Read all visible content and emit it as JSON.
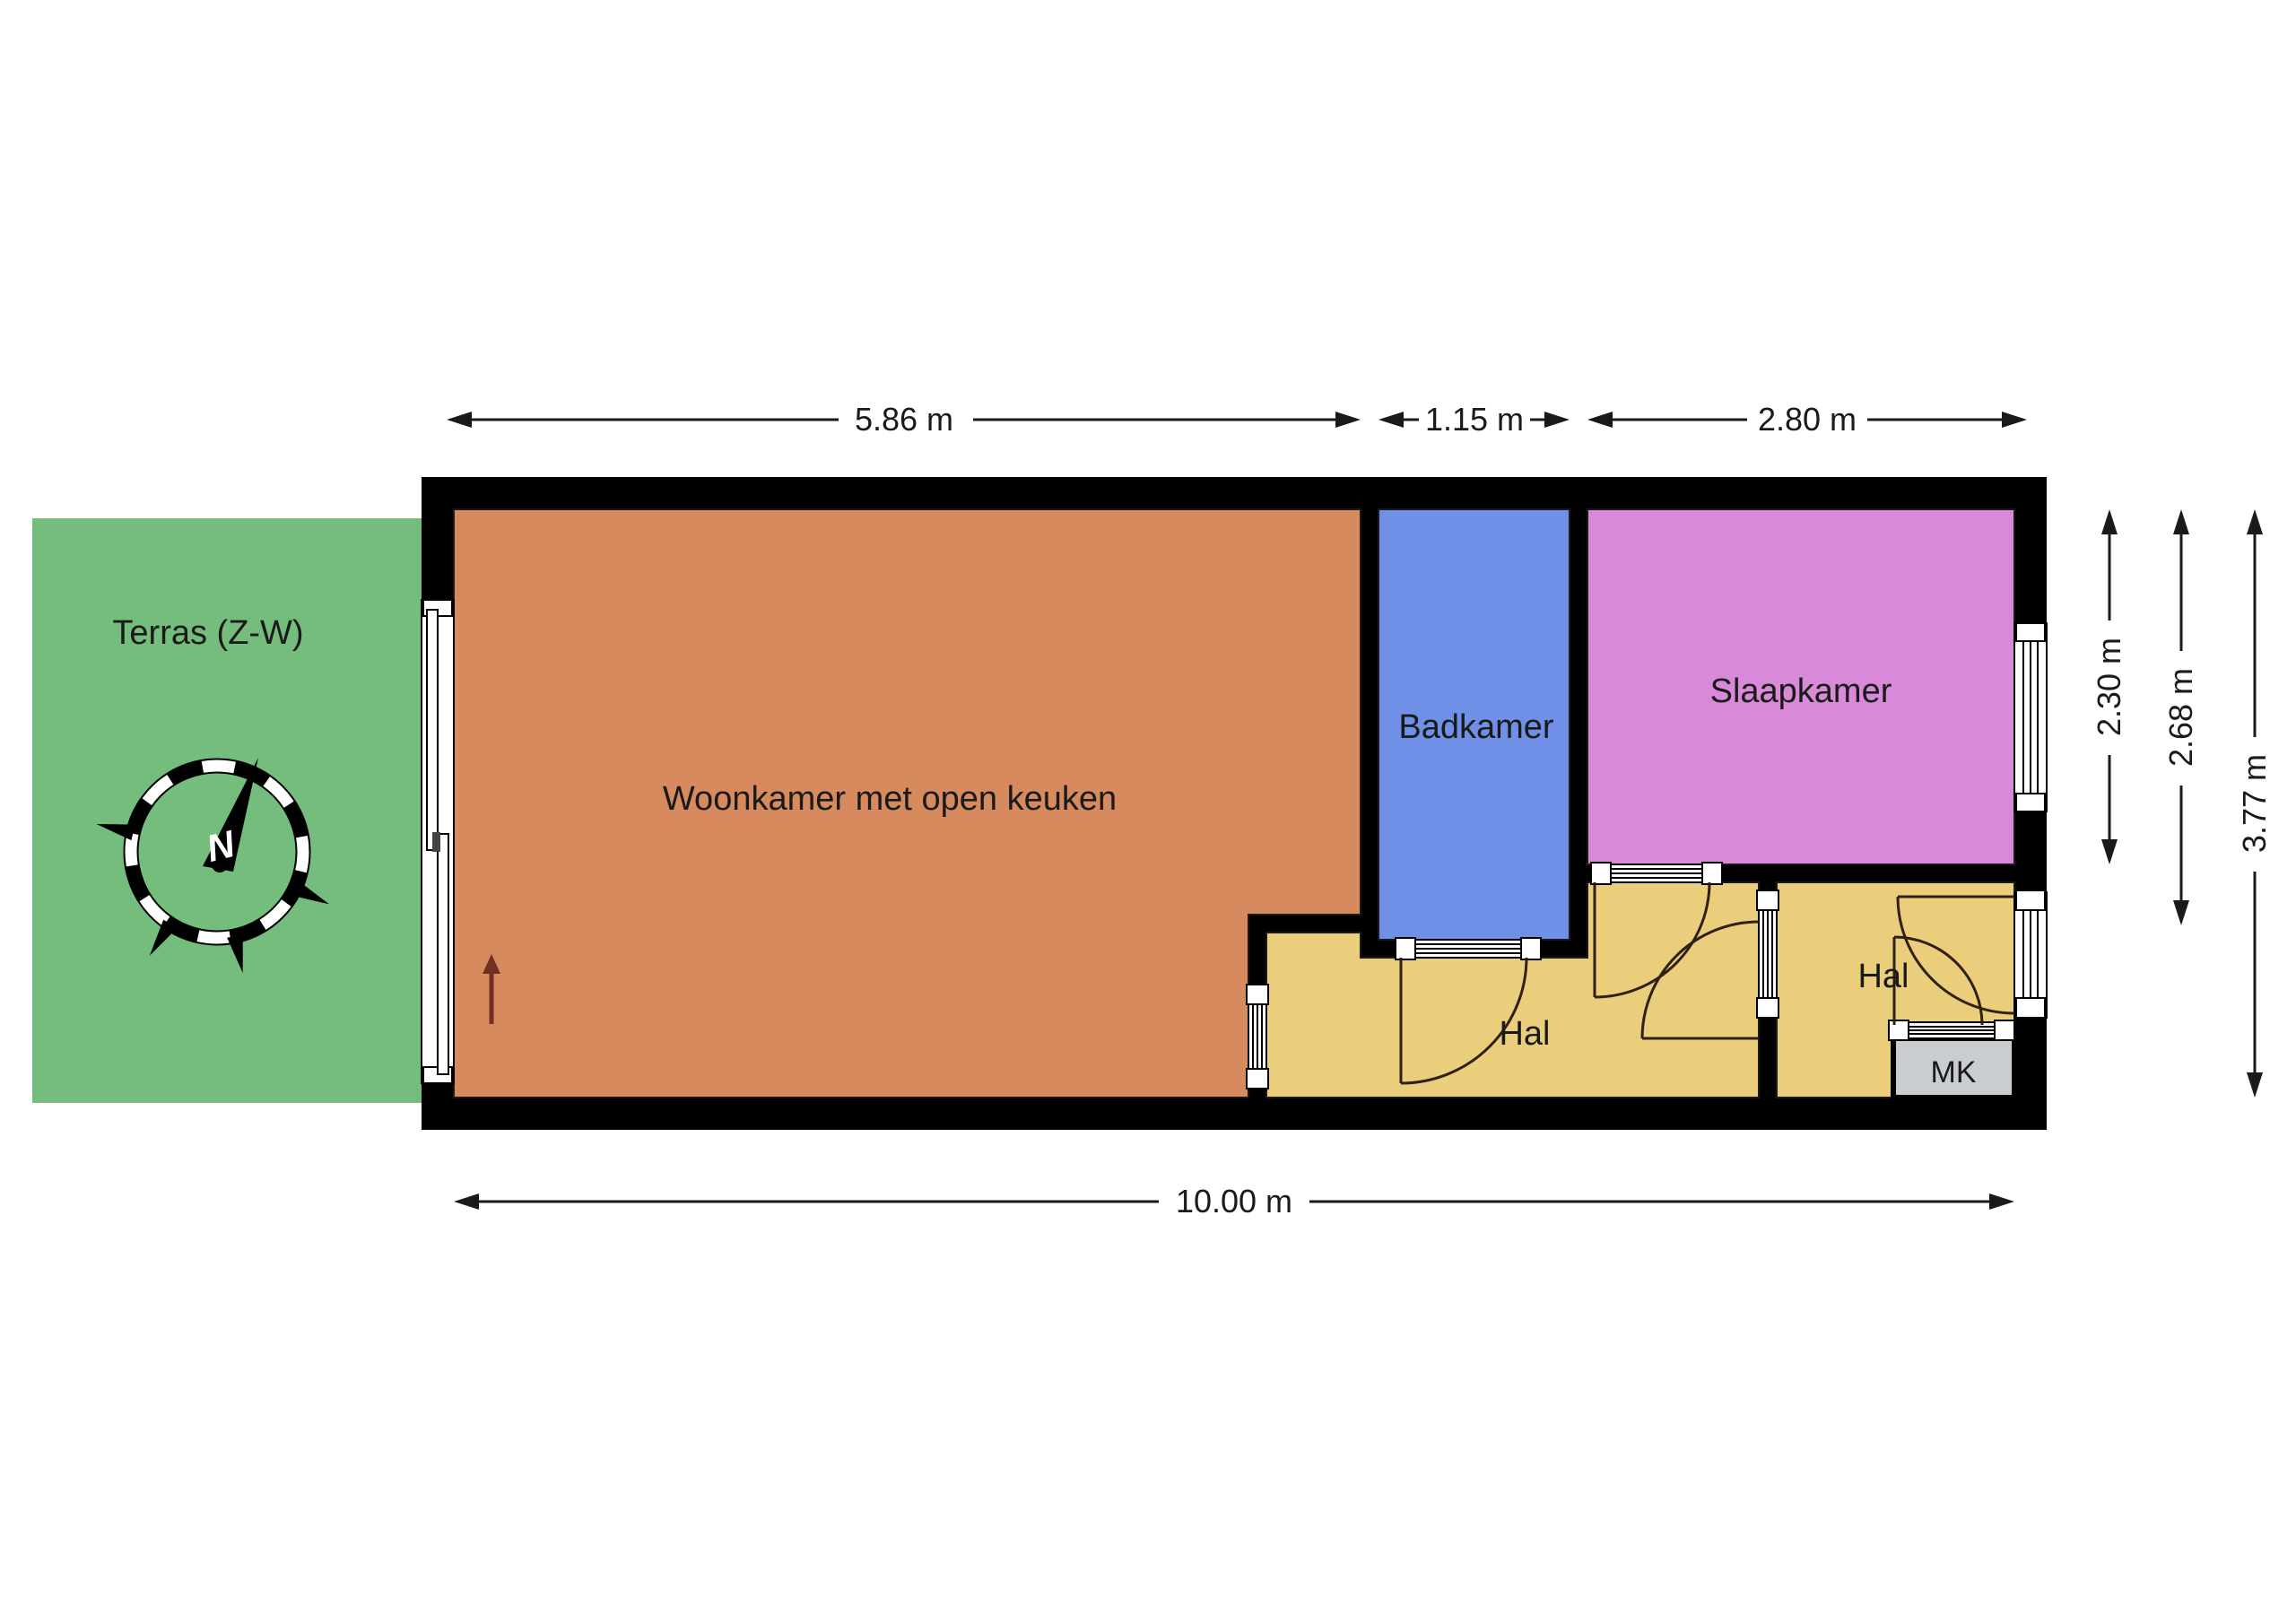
{
  "title": "Floor plan apartment",
  "terrace": {
    "label": "Terras (Z-W)"
  },
  "compass": {
    "north_label": "N"
  },
  "rooms": {
    "living": {
      "label": "Woonkamer met open keuken"
    },
    "bathroom": {
      "label": "Badkamer"
    },
    "bedroom": {
      "label": "Slaapkamer"
    },
    "hall1": {
      "label": "Hal"
    },
    "hall2": {
      "label": "Hal"
    },
    "closet": {
      "label": "MK"
    }
  },
  "dimensions": {
    "top": [
      "5.86 m",
      "1.15 m",
      "2.80 m"
    ],
    "bottom": [
      "10.00 m"
    ],
    "right": [
      "2.30 m",
      "2.68 m",
      "3.77 m"
    ]
  },
  "colors": {
    "terrace": "#74bd7c",
    "living": "#d78a5e",
    "bathroom": "#7090e8",
    "bedroom": "#d88ad8",
    "hall": "#eace7b",
    "closet": "#c9cdd0",
    "wall": "#000000",
    "entry_arrow": "#703024"
  }
}
